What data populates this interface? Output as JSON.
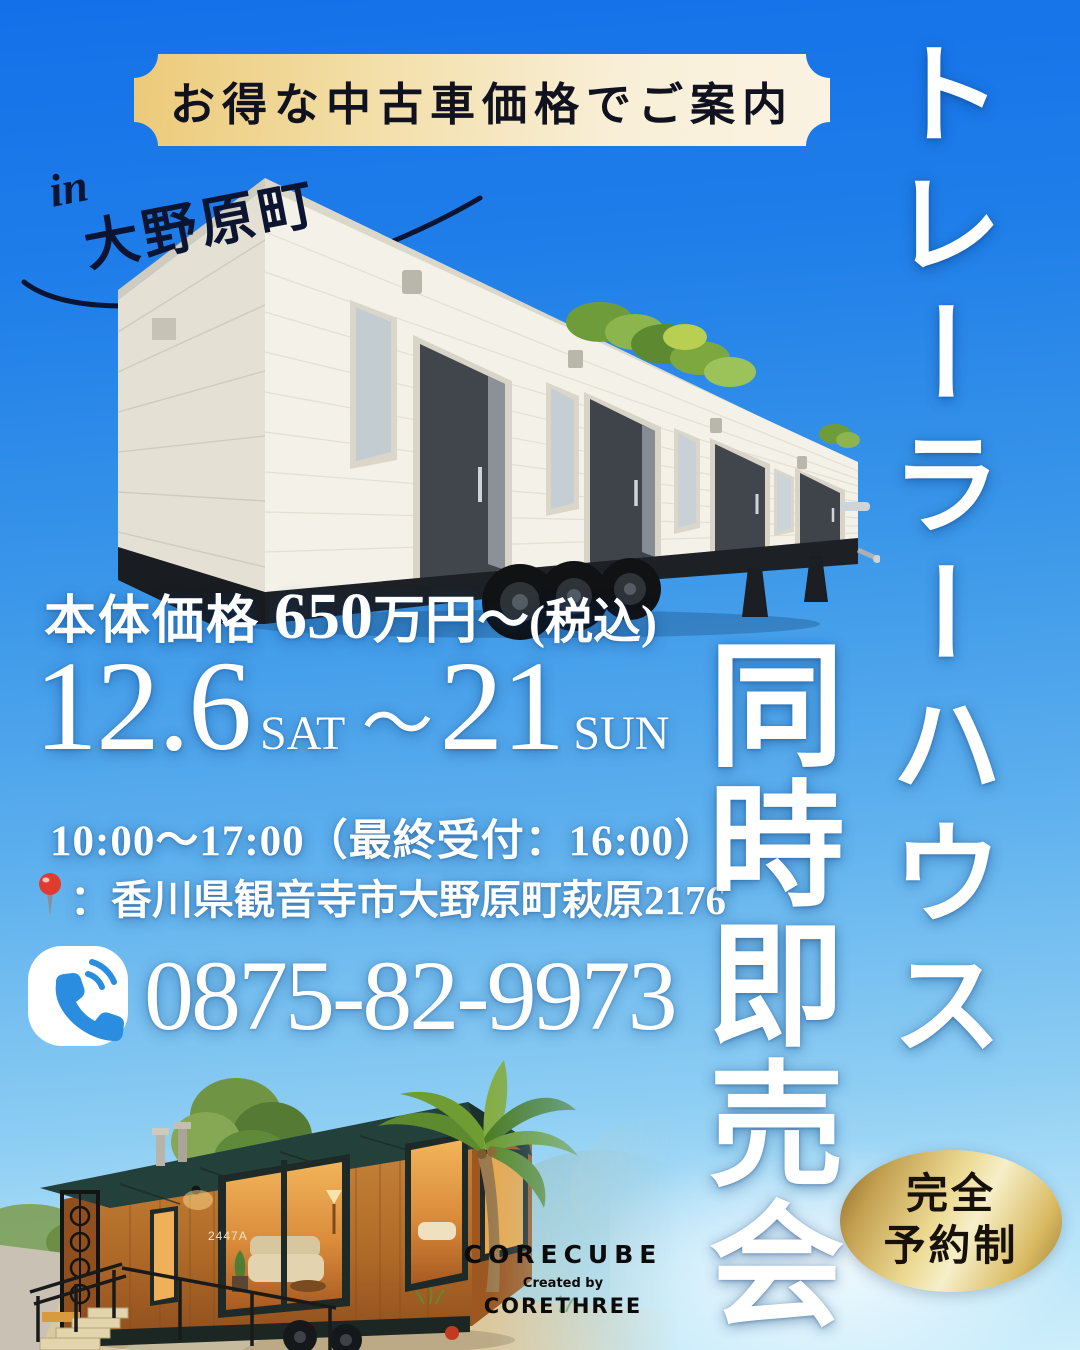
{
  "banner": {
    "label": "お得な中古車価格でご案内"
  },
  "location": {
    "prefix": "in",
    "town": "大野原町"
  },
  "titles": {
    "main_vertical": "トレーラーハウス",
    "sub_vertical": "同時即売会"
  },
  "price": {
    "label": "本体価格",
    "amount": "650",
    "unit": "万円〜",
    "tax_note": "(税込)"
  },
  "dates": {
    "start": "12.6",
    "start_day": "SAT",
    "tilde": "〜",
    "end": "21",
    "end_day": "SUN"
  },
  "hours": {
    "text": "10:00〜17:00（最終受付：16:00）"
  },
  "venue": {
    "colon": "：",
    "address": "香川県観音寺市大野原町萩原2176"
  },
  "contact": {
    "phone": "0875-82-9973"
  },
  "badge": {
    "line1": "完全",
    "line2": "予約制"
  },
  "logo": {
    "brand": "CORECUBE",
    "created_by": "Created by",
    "company": "CORETHREE"
  },
  "cabin": {
    "house_number": "2447A"
  },
  "colors": {
    "sky_top": "#1470e9",
    "sky_bottom": "#cdeefb",
    "banner_gold": "#ecca79",
    "banner_cream": "#faf3e2",
    "badge_gold": "#ecd992",
    "ink": "#0b1430",
    "text_white": "#ffffff",
    "map_pin_red": "#e23a2e"
  }
}
